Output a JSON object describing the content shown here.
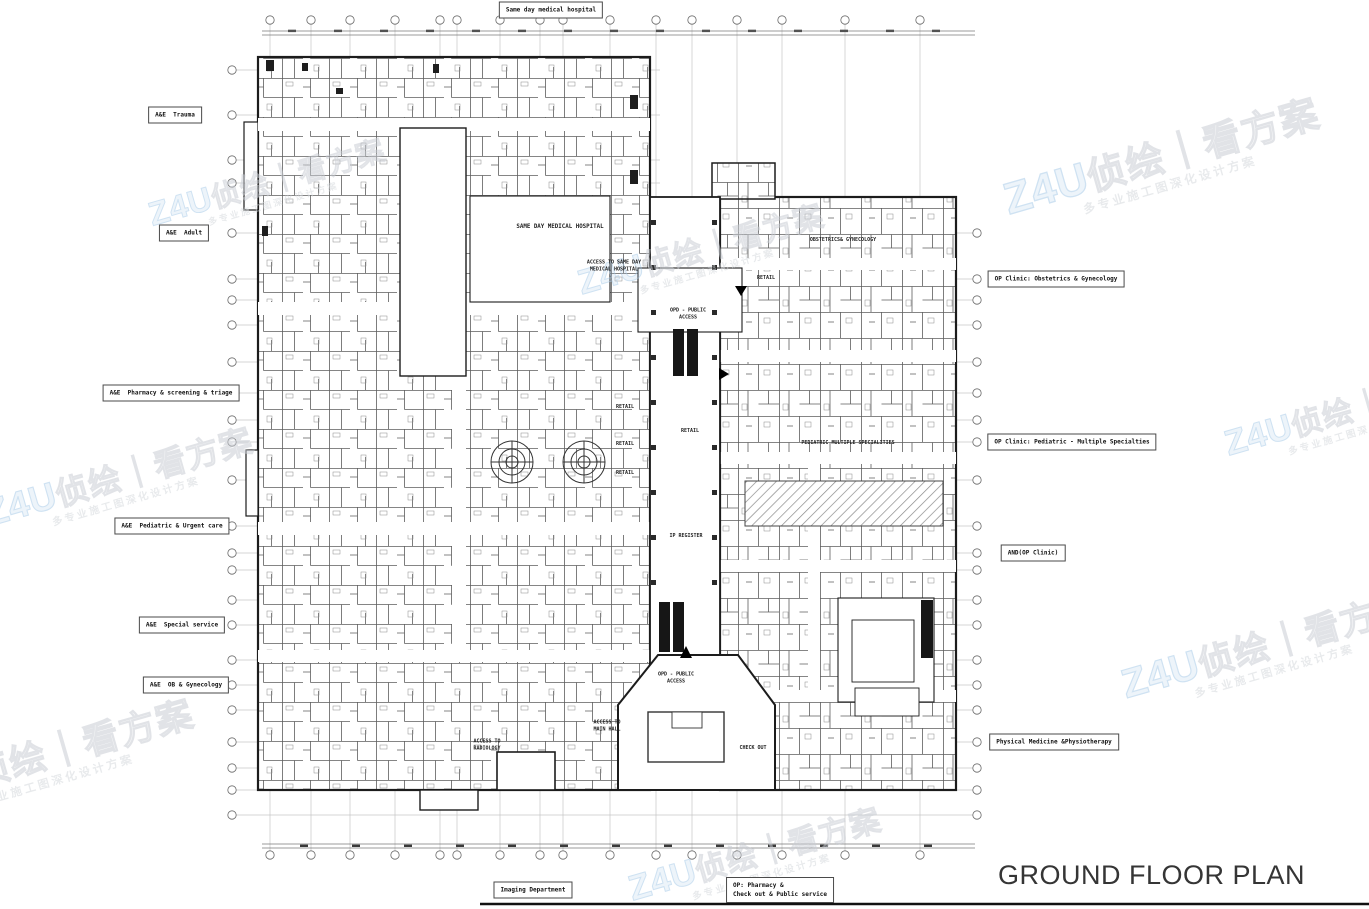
{
  "title": "GROUND FLOOR PLAN",
  "callouts": {
    "top": [
      {
        "label": "Same day medical hospital",
        "x": 551,
        "y": 10
      }
    ],
    "left": [
      {
        "label": "A&E  Trauma",
        "x": 175,
        "y": 115
      },
      {
        "label": "A&E  Adult",
        "x": 184,
        "y": 233
      },
      {
        "label": "A&E  Pharmacy & screening & triage",
        "x": 171,
        "y": 393
      },
      {
        "label": "A&E  Pediatric & Urgent care",
        "x": 172,
        "y": 526
      },
      {
        "label": "A&E  Special service",
        "x": 182,
        "y": 625
      },
      {
        "label": "A&E  OB & Gynecology",
        "x": 186,
        "y": 685
      }
    ],
    "right": [
      {
        "label": "OP Clinic: Obstetrics & Gynecology",
        "x": 1056,
        "y": 279
      },
      {
        "label": "OP Clinic: Pediatric - Multiple Specialties",
        "x": 1072,
        "y": 442
      },
      {
        "label": "AND(OP Clinic)",
        "x": 1033,
        "y": 553
      },
      {
        "label": "Physical Medicine &Physiotherapy",
        "x": 1054,
        "y": 742
      }
    ],
    "bottom": [
      {
        "label": "Imaging Department",
        "x": 533,
        "y": 890
      },
      {
        "label": "OP: Pharmacy &\nCheck out & Public service",
        "x": 780,
        "y": 890,
        "cls": "ta-left"
      }
    ]
  },
  "plan_labels": [
    {
      "label": "SAME DAY MEDICAL HOSPITAL",
      "x": 560,
      "y": 228,
      "cls": "lg"
    },
    {
      "label": "ACCESS TO SAME DAY\nMEDICAL HOSPITAL",
      "x": 614,
      "y": 266
    },
    {
      "label": "OPD - PUBLIC\nACCESS",
      "x": 688,
      "y": 314
    },
    {
      "label": "RETAIL",
      "x": 766,
      "y": 278
    },
    {
      "label": "RETAIL",
      "x": 625,
      "y": 407
    },
    {
      "label": "RETAIL",
      "x": 625,
      "y": 444
    },
    {
      "label": "RETAIL",
      "x": 625,
      "y": 473
    },
    {
      "label": "RETAIL",
      "x": 690,
      "y": 431
    },
    {
      "label": "OBSTETRICS& GYNECOLOGY",
      "x": 843,
      "y": 240
    },
    {
      "label": "PEDIATRIC MULTIPLE SPECIALITIES",
      "x": 848,
      "y": 443
    },
    {
      "label": "IP REGISTER",
      "x": 686,
      "y": 536
    },
    {
      "label": "OPD - PUBLIC\nACCESS",
      "x": 676,
      "y": 678
    },
    {
      "label": "ACCESS TO\nMAIN HALL",
      "x": 607,
      "y": 726
    },
    {
      "label": "ACCESS TO\nRADIOLOGY",
      "x": 487,
      "y": 745
    },
    {
      "label": "CHECK OUT",
      "x": 753,
      "y": 748
    }
  ],
  "watermark": {
    "brand": "Z4U",
    "text": "侦绘｜看方案",
    "subtext": "多专业施工图深化设计方案",
    "brand_color": "#a8cbe8",
    "text_color": "#c9cdd4"
  },
  "colors": {
    "wall": "#1c1c1c",
    "grid_line": "#c6c6c6",
    "hatch": "#8a8a8a",
    "title_color": "#353535"
  }
}
